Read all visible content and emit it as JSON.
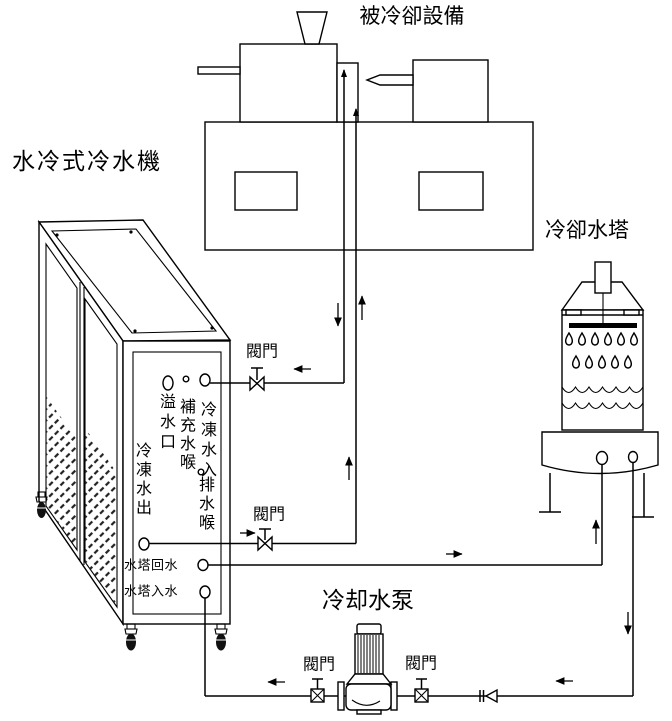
{
  "canvas": {
    "width": 672,
    "height": 721,
    "background": "#ffffff",
    "line_color": "#000000"
  },
  "labels": {
    "chiller": "水冷式冷水機",
    "equipment": "被冷卻設備",
    "tower": "冷卻水塔",
    "pump": "冷却水泵",
    "valve": "閥門"
  },
  "chiller_panel": {
    "overflow_port": "溢水口",
    "makeup_hose": "補充水喉",
    "chilled_water_in": "冷凍水入",
    "drain_hose": "排水喉",
    "chilled_water_out": "冷凍水出",
    "tower_return": "水塔回水",
    "tower_inlet": "水塔入水"
  }
}
